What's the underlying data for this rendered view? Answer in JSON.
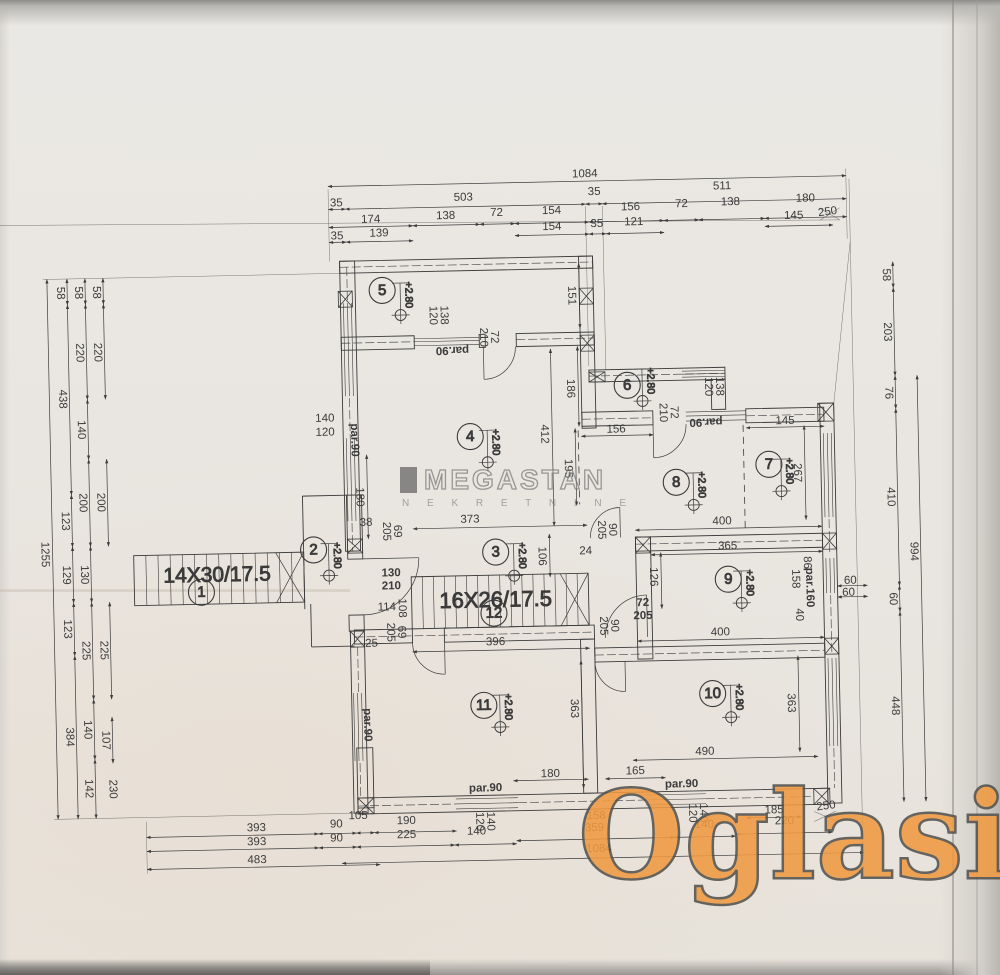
{
  "watermarks": {
    "megastan": {
      "text": "MEGASTAN",
      "sub": "N E K R E T N I N E"
    },
    "oglasi": {
      "text": "Oglasi",
      "suffix": ".rs",
      "color": "#f09a41"
    }
  },
  "plan": {
    "level_label": "+2.80",
    "stairs": [
      {
        "label": "14X30/17.5",
        "x": 133,
        "y": 548,
        "w": 170,
        "h": 50,
        "n": 14,
        "lx": 216,
        "ly": 570,
        "fs": 21
      },
      {
        "label": "16X26/17.5",
        "x": 410,
        "y": 575,
        "w": 177,
        "h": 52,
        "n": 16,
        "lx": 494,
        "ly": 601,
        "fs": 22
      }
    ],
    "rooms": [
      {
        "n": "1",
        "x": 200,
        "y": 586
      },
      {
        "n": "2",
        "x": 313,
        "y": 546
      },
      {
        "n": "3",
        "x": 495,
        "y": 552
      },
      {
        "n": "4",
        "x": 472,
        "y": 436
      },
      {
        "n": "5",
        "x": 387,
        "y": 288
      },
      {
        "n": "6",
        "x": 630,
        "y": 388
      },
      {
        "n": "7",
        "x": 770,
        "y": 470
      },
      {
        "n": "8",
        "x": 677,
        "y": 486
      },
      {
        "n": "9",
        "x": 727,
        "y": 584
      },
      {
        "n": "10",
        "x": 709,
        "y": 698
      },
      {
        "n": "11",
        "x": 480,
        "y": 705
      },
      {
        "n": "12",
        "x": 492,
        "y": 613
      }
    ],
    "levels": [
      {
        "x": 405,
        "y": 313
      },
      {
        "x": 489,
        "y": 462
      },
      {
        "x": 328,
        "y": 572
      },
      {
        "x": 513,
        "y": 576
      },
      {
        "x": 645,
        "y": 404
      },
      {
        "x": 694,
        "y": 509
      },
      {
        "x": 782,
        "y": 497
      },
      {
        "x": 740,
        "y": 608
      },
      {
        "x": 496,
        "y": 727
      },
      {
        "x": 727,
        "y": 722
      }
    ],
    "dims": [
      {
        "t": "1084",
        "x": 592,
        "y": 176,
        "line": [
          335,
          183,
          853,
          183
        ]
      },
      {
        "t": "35",
        "x": 343,
        "y": 200,
        "line": [
          335,
          206,
          352,
          206
        ]
      },
      {
        "t": "503",
        "x": 470,
        "y": 197,
        "line": [
          352,
          206,
          592,
          206
        ]
      },
      {
        "t": "35",
        "x": 601,
        "y": 194,
        "line": [
          592,
          206,
          609,
          206
        ]
      },
      {
        "t": "511",
        "x": 729,
        "y": 191,
        "line": [
          609,
          206,
          853,
          206
        ]
      },
      {
        "t": "174",
        "x": 377,
        "y": 217,
        "line": [
          335,
          224,
          419,
          224
        ]
      },
      {
        "t": "138",
        "x": 452,
        "y": 215,
        "line": [
          419,
          224,
          486,
          224
        ]
      },
      {
        "t": "72",
        "x": 503,
        "y": 213,
        "line": [
          486,
          224,
          521,
          224
        ]
      },
      {
        "t": "154",
        "x": 558,
        "y": 212,
        "line": [
          521,
          224,
          595,
          224
        ]
      },
      {
        "t": "156",
        "x": 637,
        "y": 210,
        "line": [
          595,
          224,
          670,
          224
        ]
      },
      {
        "t": "72",
        "x": 688,
        "y": 208,
        "line": [
          670,
          224,
          705,
          224
        ]
      },
      {
        "t": "138",
        "x": 737,
        "y": 207,
        "line": [
          705,
          224,
          771,
          224
        ]
      },
      {
        "t": "180",
        "x": 812,
        "y": 205,
        "line": [
          771,
          224,
          853,
          224
        ]
      },
      {
        "t": "35",
        "x": 343,
        "y": 233,
        "line": [
          335,
          239,
          352,
          239
        ]
      },
      {
        "t": "139",
        "x": 385,
        "y": 231,
        "line": [
          352,
          239,
          419,
          239
        ]
      },
      {
        "t": "154",
        "x": 558,
        "y": 228,
        "line": [
          521,
          236,
          595,
          236
        ]
      },
      {
        "t": "35",
        "x": 603,
        "y": 226,
        "line": [
          595,
          236,
          612,
          236
        ]
      },
      {
        "t": "121",
        "x": 640,
        "y": 225,
        "line": [
          612,
          236,
          670,
          236
        ]
      },
      {
        "t": "145",
        "x": 800,
        "y": 222,
        "line": [
          771,
          232,
          839,
          232
        ]
      },
      {
        "t": "250",
        "x": 834,
        "y": 219,
        "r": -6
      },
      {
        "t": "1255",
        "x": 44,
        "y": 545,
        "r": 90,
        "line": [
          52,
          270,
          52,
          810
        ]
      },
      {
        "t": "58",
        "x": 65,
        "y": 284,
        "r": 90,
        "line": [
          72,
          270,
          72,
          296
        ]
      },
      {
        "t": "438",
        "x": 65,
        "y": 390,
        "r": 90,
        "line": [
          72,
          296,
          72,
          486
        ]
      },
      {
        "t": "123",
        "x": 65,
        "y": 512,
        "r": 90,
        "line": [
          72,
          486,
          72,
          538
        ]
      },
      {
        "t": "129",
        "x": 65,
        "y": 566,
        "r": 90,
        "line": [
          72,
          538,
          72,
          594
        ]
      },
      {
        "t": "123",
        "x": 65,
        "y": 620,
        "r": 90,
        "line": [
          72,
          594,
          72,
          647
        ]
      },
      {
        "t": "384",
        "x": 65,
        "y": 728,
        "r": 90,
        "line": [
          72,
          647,
          72,
          810
        ]
      },
      {
        "t": "58",
        "x": 83,
        "y": 284,
        "r": 90,
        "line": [
          90,
          270,
          90,
          296
        ]
      },
      {
        "t": "220",
        "x": 83,
        "y": 344,
        "r": 90,
        "line": [
          90,
          296,
          90,
          391
        ]
      },
      {
        "t": "140",
        "x": 83,
        "y": 421,
        "r": 90,
        "line": [
          90,
          391,
          90,
          451
        ]
      },
      {
        "t": "200",
        "x": 83,
        "y": 494,
        "r": 90,
        "line": [
          90,
          451,
          90,
          538
        ]
      },
      {
        "t": "130",
        "x": 83,
        "y": 566,
        "r": 90,
        "line": [
          90,
          538,
          90,
          594
        ]
      },
      {
        "t": "225",
        "x": 83,
        "y": 642,
        "r": 90,
        "line": [
          90,
          594,
          90,
          691
        ]
      },
      {
        "t": "140",
        "x": 83,
        "y": 721,
        "r": 90,
        "line": [
          90,
          691,
          90,
          751
        ]
      },
      {
        "t": "142",
        "x": 83,
        "y": 780,
        "r": 90,
        "line": [
          90,
          751,
          90,
          810
        ]
      },
      {
        "t": "58",
        "x": 101,
        "y": 284,
        "r": 90,
        "line": [
          108,
          270,
          108,
          296
        ]
      },
      {
        "t": "220",
        "x": 101,
        "y": 344,
        "r": 90,
        "line": [
          108,
          296,
          108,
          391
        ]
      },
      {
        "t": "200",
        "x": 101,
        "y": 494,
        "r": 90,
        "line": [
          108,
          451,
          108,
          538
        ]
      },
      {
        "t": "225",
        "x": 101,
        "y": 642,
        "r": 90,
        "line": [
          108,
          594,
          108,
          691
        ]
      },
      {
        "t": "107",
        "x": 101,
        "y": 732,
        "r": 90,
        "line": [
          108,
          709,
          108,
          755
        ]
      },
      {
        "t": "230",
        "x": 107,
        "y": 781,
        "r": 90
      },
      {
        "t": "58",
        "x": 891,
        "y": 283,
        "r": 90,
        "line": [
          898,
          270,
          898,
          296
        ]
      },
      {
        "t": "203",
        "x": 891,
        "y": 340,
        "r": 90,
        "line": [
          898,
          296,
          898,
          384
        ]
      },
      {
        "t": "76",
        "x": 891,
        "y": 401,
        "r": 90,
        "line": [
          898,
          384,
          898,
          417
        ]
      },
      {
        "t": "410",
        "x": 891,
        "y": 505,
        "r": 90,
        "line": [
          898,
          417,
          898,
          594
        ]
      },
      {
        "t": "60",
        "x": 891,
        "y": 607,
        "r": 90,
        "line": [
          898,
          594,
          898,
          620
        ]
      },
      {
        "t": "448",
        "x": 891,
        "y": 714,
        "r": 90,
        "line": [
          898,
          620,
          898,
          810
        ]
      },
      {
        "t": "994",
        "x": 913,
        "y": 560,
        "r": 90,
        "line": [
          920,
          384,
          920,
          810
        ]
      },
      {
        "t": "151",
        "x": 576,
        "y": 297,
        "r": 90,
        "line": [
          584,
          265,
          584,
          330
        ]
      },
      {
        "t": "186",
        "x": 573,
        "y": 390,
        "r": 90,
        "line": [
          581,
          348,
          581,
          428
        ]
      },
      {
        "t": "195",
        "x": 569,
        "y": 470,
        "r": 90,
        "line": [
          577,
          430,
          577,
          507
        ]
      },
      {
        "t": "412",
        "x": 546,
        "y": 435,
        "r": 90,
        "line": [
          554,
          350,
          554,
          527
        ]
      },
      {
        "t": "106",
        "x": 541,
        "y": 557,
        "r": 90,
        "line": [
          549,
          535,
          549,
          578
        ]
      },
      {
        "t": "126",
        "x": 652,
        "y": 580,
        "r": 90,
        "line": [
          660,
          556,
          660,
          612
        ]
      },
      {
        "t": "267",
        "x": 798,
        "y": 479,
        "r": 90,
        "line": [
          806,
          432,
          806,
          526
        ]
      },
      {
        "t": "363",
        "x": 570,
        "y": 710,
        "r": 90,
        "line": [
          578,
          662,
          578,
          790
        ]
      },
      {
        "t": "363",
        "x": 787,
        "y": 709,
        "r": 90,
        "line": [
          795,
          662,
          795,
          758
        ]
      },
      {
        "t": "86",
        "x": 806,
        "y": 569,
        "r": 90
      },
      {
        "t": "158",
        "x": 794,
        "y": 585,
        "r": 90
      },
      {
        "t": "40",
        "x": 797,
        "y": 621,
        "r": 90
      },
      {
        "t": "108",
        "x": 400,
        "y": 606,
        "r": 90
      },
      {
        "t": "180",
        "x": 360,
        "y": 494,
        "r": 90,
        "line": [
          368,
          452,
          368,
          536
        ]
      },
      {
        "t": "373",
        "x": 470,
        "y": 519,
        "line": [
          413,
          527,
          587,
          527
        ]
      },
      {
        "t": "400",
        "x": 722,
        "y": 526,
        "line": [
          635,
          533,
          822,
          533
        ]
      },
      {
        "t": "365",
        "x": 727,
        "y": 551,
        "line": [
          650,
          558,
          822,
          558
        ]
      },
      {
        "t": "400",
        "x": 718,
        "y": 637,
        "line": [
          635,
          644,
          822,
          644
        ]
      },
      {
        "t": "396",
        "x": 493,
        "y": 642,
        "line": [
          410,
          650,
          587,
          650
        ]
      },
      {
        "t": "490",
        "x": 700,
        "y": 756,
        "line": [
          628,
          763,
          813,
          763
        ]
      },
      {
        "t": "165",
        "x": 630,
        "y": 774,
        "line": [
          600,
          781,
          660,
          781
        ]
      },
      {
        "t": "180",
        "x": 545,
        "y": 775,
        "line": [
          508,
          781,
          583,
          781
        ]
      },
      {
        "t": "156",
        "x": 618,
        "y": 432,
        "line": [
          583,
          438,
          655,
          438
        ]
      },
      {
        "t": "145",
        "x": 787,
        "y": 427,
        "line": [
          748,
          433,
          826,
          433
        ]
      },
      {
        "t": "60",
        "x": 849,
        "y": 588,
        "line": [
          836,
          593,
          866,
          593
        ]
      },
      {
        "t": "60",
        "x": 847,
        "y": 600,
        "line": [
          836,
          604,
          866,
          604
        ]
      },
      {
        "t": "138",
        "x": 448,
        "y": 314,
        "r": 90
      },
      {
        "t": "120",
        "x": 437,
        "y": 314,
        "r": 90
      },
      {
        "t": "72",
        "x": 498,
        "y": 337,
        "r": 90
      },
      {
        "t": "210",
        "x": 487,
        "y": 337,
        "r": 90
      },
      {
        "t": "140",
        "x": 327,
        "y": 415
      },
      {
        "t": "120",
        "x": 327,
        "y": 429
      },
      {
        "t": "par.90",
        "x": 356,
        "y": 437,
        "r": 90,
        "b": 1
      },
      {
        "t": "par.90",
        "x": 456,
        "y": 349,
        "r": 180,
        "b": 1
      },
      {
        "t": "38",
        "x": 366,
        "y": 520
      },
      {
        "t": "69",
        "x": 397,
        "y": 529,
        "r": 90
      },
      {
        "t": "205",
        "x": 386,
        "y": 529,
        "r": 90
      },
      {
        "t": "130",
        "x": 390,
        "y": 571,
        "b": 1
      },
      {
        "t": "210",
        "x": 390,
        "y": 584,
        "b": 1
      },
      {
        "t": "114",
        "x": 385,
        "y": 605
      },
      {
        "t": "25",
        "x": 369,
        "y": 641
      },
      {
        "t": "69",
        "x": 399,
        "y": 630,
        "r": 90
      },
      {
        "t": "205",
        "x": 388,
        "y": 630,
        "r": 90
      },
      {
        "t": "90",
        "x": 612,
        "y": 532,
        "r": 90
      },
      {
        "t": "205",
        "x": 601,
        "y": 532,
        "r": 90
      },
      {
        "t": "24",
        "x": 585,
        "y": 553
      },
      {
        "t": "90",
        "x": 612,
        "y": 628,
        "r": 90
      },
      {
        "t": "205",
        "x": 601,
        "y": 628,
        "r": 90
      },
      {
        "t": "72",
        "x": 641,
        "y": 606,
        "b": 1
      },
      {
        "t": "205",
        "x": 641,
        "y": 619,
        "b": 1
      },
      {
        "t": "138",
        "x": 722,
        "y": 391,
        "r": 90
      },
      {
        "t": "120",
        "x": 711,
        "y": 391,
        "r": 90
      },
      {
        "t": "par.90",
        "x": 708,
        "y": 426,
        "r": 180,
        "b": 1
      },
      {
        "t": "72",
        "x": 676,
        "y": 416,
        "r": 90
      },
      {
        "t": "210",
        "x": 665,
        "y": 416,
        "r": 90
      },
      {
        "t": "par.160",
        "x": 808,
        "y": 594,
        "r": 90,
        "b": 1
      },
      {
        "t": "par.90",
        "x": 363,
        "y": 722,
        "r": 90,
        "b": 1
      },
      {
        "t": "par.90",
        "x": 480,
        "y": 788,
        "b": 1
      },
      {
        "t": "140",
        "x": 484,
        "y": 821,
        "r": 90
      },
      {
        "t": "120",
        "x": 473,
        "y": 821,
        "r": 90
      },
      {
        "t": "par.90",
        "x": 676,
        "y": 788,
        "b": 1
      },
      {
        "t": "140",
        "x": 697,
        "y": 817,
        "r": 90
      },
      {
        "t": "120",
        "x": 686,
        "y": 817,
        "r": 90
      },
      {
        "t": "393",
        "x": 250,
        "y": 823,
        "line": [
          140,
          830,
          312,
          830
        ]
      },
      {
        "t": "90",
        "x": 330,
        "y": 821,
        "line": [
          312,
          830,
          350,
          830
        ]
      },
      {
        "t": "105",
        "x": 352,
        "y": 813,
        "line": [
          350,
          830,
          368,
          830
        ]
      },
      {
        "t": "190",
        "x": 400,
        "y": 819,
        "line": [
          368,
          830,
          450,
          830
        ]
      },
      {
        "t": "158",
        "x": 590,
        "y": 818
      },
      {
        "t": "185",
        "x": 768,
        "y": 816,
        "line": [
          740,
          823,
          795,
          823
        ]
      },
      {
        "t": "250",
        "x": 820,
        "y": 813,
        "r": -6
      },
      {
        "t": "393",
        "x": 250,
        "y": 837,
        "line": [
          140,
          844,
          312,
          844
        ]
      },
      {
        "t": "90",
        "x": 330,
        "y": 835,
        "line": [
          312,
          844,
          350,
          844
        ]
      },
      {
        "t": "225",
        "x": 400,
        "y": 833,
        "line": [
          350,
          844,
          448,
          844
        ]
      },
      {
        "t": "140",
        "x": 470,
        "y": 831,
        "line": [
          448,
          844,
          510,
          844
        ]
      },
      {
        "t": "359",
        "x": 588,
        "y": 830,
        "line": [
          510,
          841,
          668,
          841
        ]
      },
      {
        "t": "140",
        "x": 698,
        "y": 829,
        "line": [
          668,
          841,
          729,
          841
        ]
      },
      {
        "t": "220",
        "x": 778,
        "y": 827,
        "line": [
          729,
          839,
          826,
          839
        ]
      },
      {
        "t": "483",
        "x": 250,
        "y": 855,
        "line": [
          140,
          862,
          373,
          862
        ]
      },
      {
        "t": "1084",
        "x": 592,
        "y": 851,
        "line": [
          335,
          860,
          857,
          860
        ]
      }
    ]
  }
}
